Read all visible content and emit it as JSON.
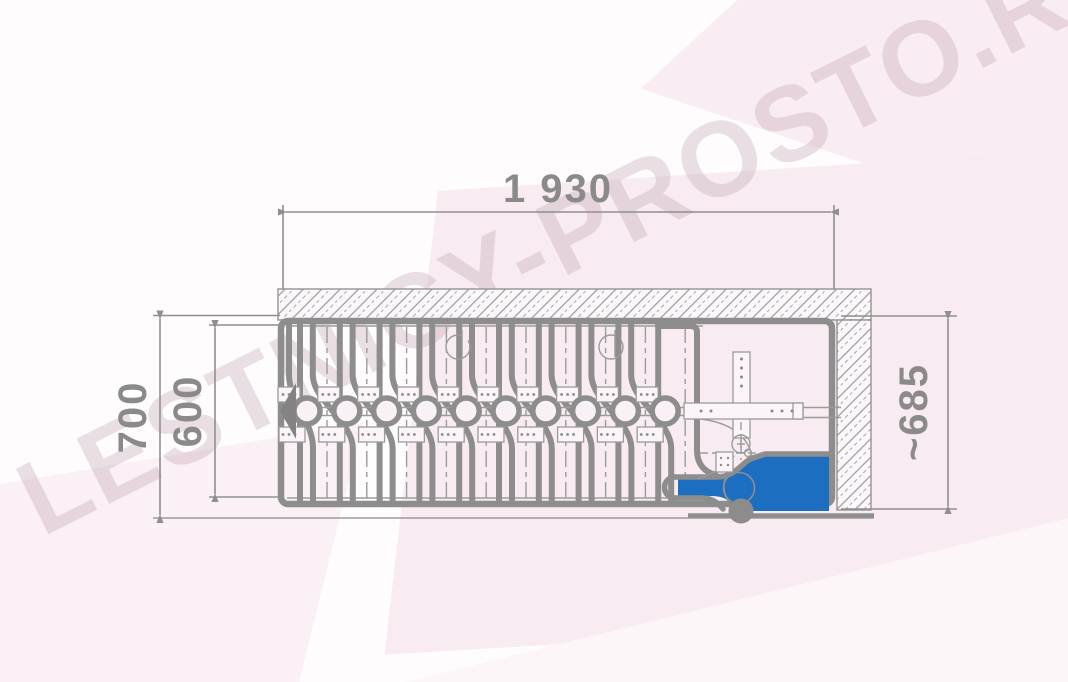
{
  "watermark": {
    "text": "LESTNICY-PROSTO.RU"
  },
  "colors": {
    "line": "#8d8d8d",
    "line_thin": "#9b9b9b",
    "dim_text": "#8a8a8a",
    "accent_blue": "#1c6fc0",
    "plate_fill": "#fbf4f8",
    "hinge_fill": "#f9f1f6",
    "watermark": "rgba(186,153,170,0.30)"
  },
  "dimensions": {
    "top_width": "1 930",
    "left_outer_height": "700",
    "left_inner_height": "600",
    "right_height": "~685"
  },
  "drawing": {
    "description": "Folded attic ladder, plan view",
    "steps": {
      "count": 10,
      "start_x": 307,
      "spacing": 39.8,
      "axis_y": 411,
      "top_y": 323,
      "bottom_y": 502
    },
    "screw_holes_x": [
      458,
      611
    ]
  }
}
